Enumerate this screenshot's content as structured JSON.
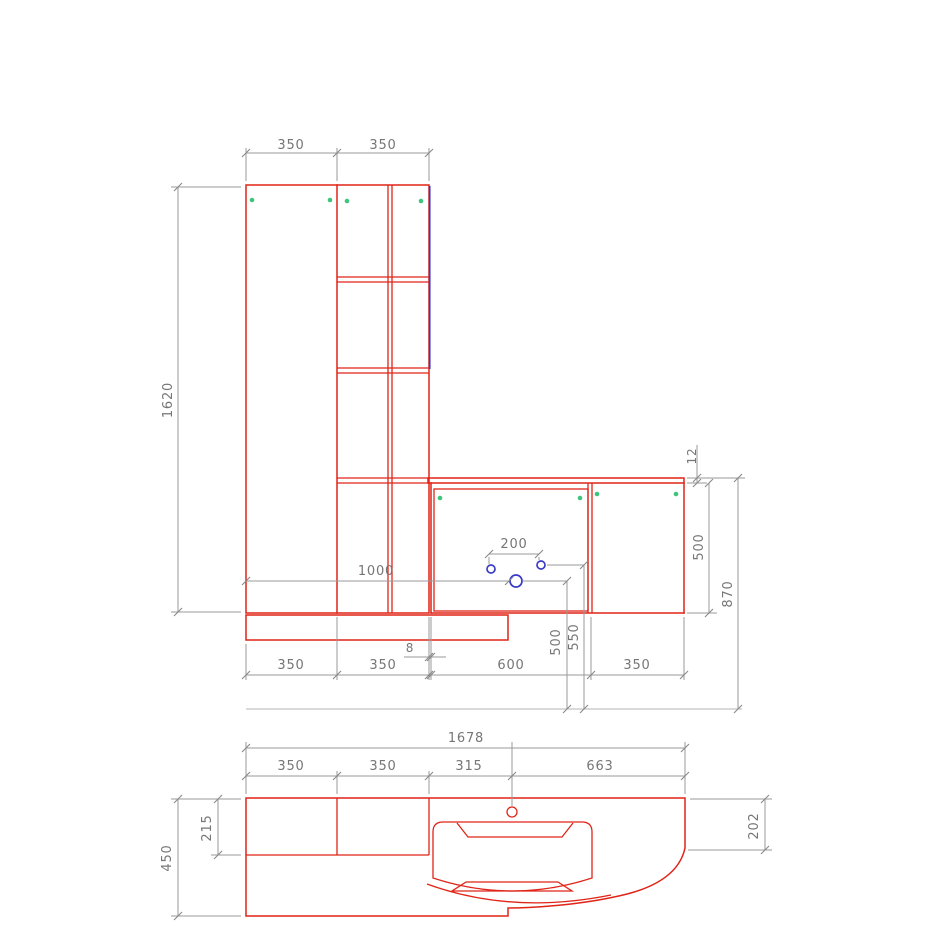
{
  "drawing_type": "bathroom furniture technical drawing (front elevation + plan view)",
  "colors": {
    "furniture_outline": "#e02417",
    "dimension_lines": "#9a9a9a",
    "dimension_text": "#767676",
    "hinge_markers": "#3fc47c",
    "highlight_edge_and_holes": "#3a3ac8",
    "background": "#ffffff"
  },
  "elevation": {
    "dim_top_left_width": "350",
    "dim_top_right_width": "350",
    "dim_height": "1620",
    "dim_worktop_thickness": "12",
    "dim_base_unit_height": "500",
    "dim_worktop_height_from_floor": "870",
    "dim_hole_spacing": "200",
    "dim_hole_from_left": "1000",
    "dim_drain_height": "500",
    "dim_faucet_height": "550",
    "dim_gap": "8",
    "dim_bottom_w1": "350",
    "dim_bottom_w2": "350",
    "dim_bottom_w3": "600",
    "dim_bottom_w4": "350"
  },
  "plan": {
    "dim_total_width": "1678",
    "dim_w1": "350",
    "dim_w2": "350",
    "dim_w3": "315",
    "dim_w4": "663",
    "dim_depth": "450",
    "dim_upper_section_depth": "215",
    "dim_right_end_depth": "202"
  }
}
